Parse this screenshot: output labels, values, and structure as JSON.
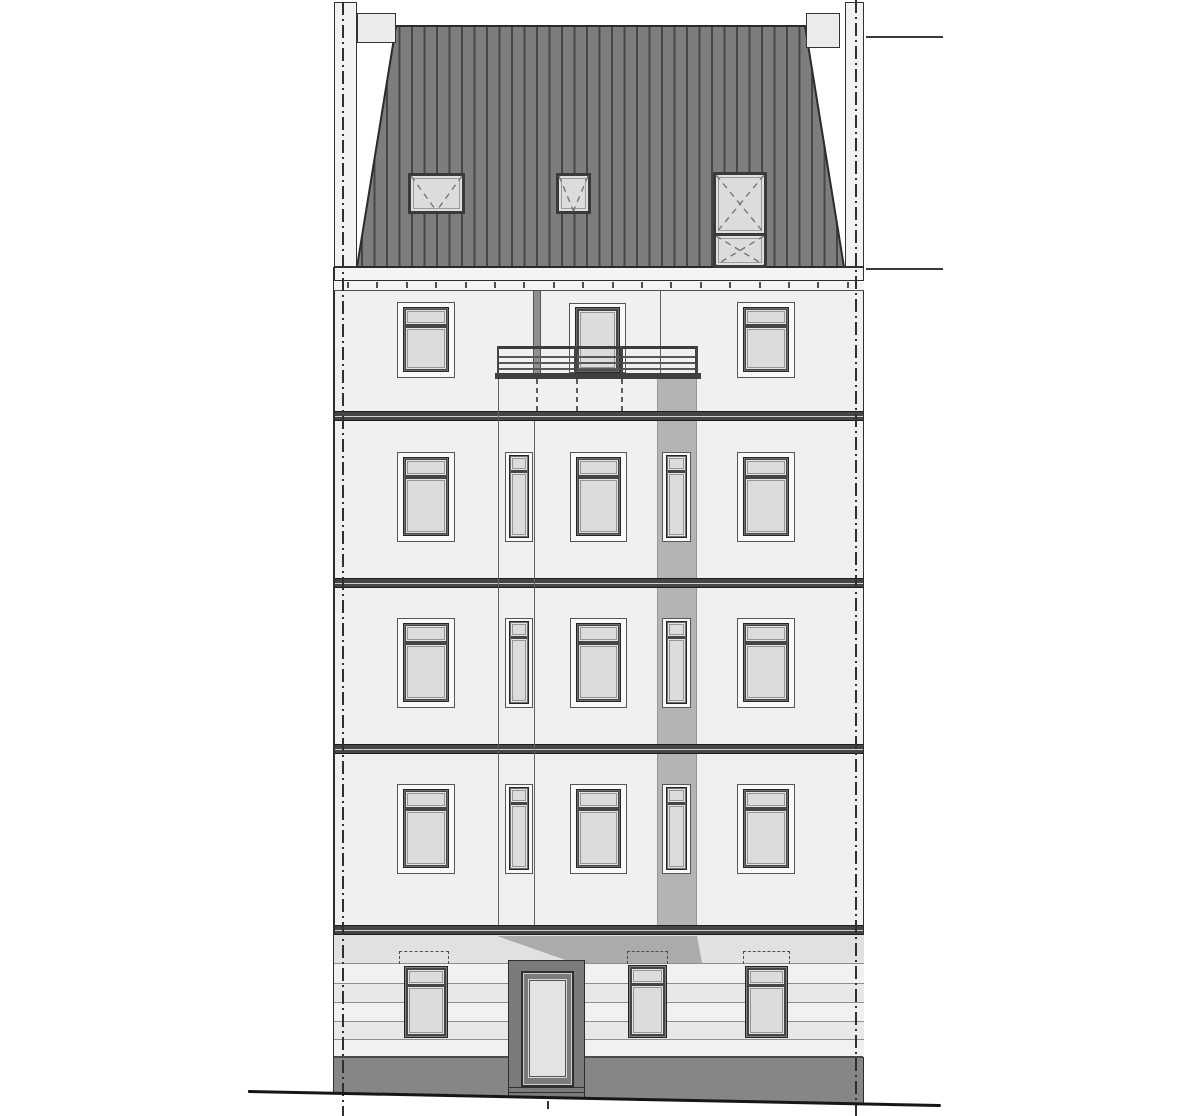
{
  "meta": {
    "description": "Front elevation architectural drawing of a 5-storey residential building: standing-seam mansard roof with two chimneys and three roof hatches, four upper floors with tilt-transom windows and narrow stair windows, a top-floor balcony with railing, a grey refuse/chute band descending the facade, a rusticated ground floor with central entrance door, dark plinth and sloping ground line, dash-dot plot boundary lines on both sides and two horizontal reference lines at the right edge."
  },
  "colors": {
    "page": "#ffffff",
    "wall": "#f0f0f0",
    "wall_edge": "#2e2e2e",
    "surround": "#f9f9f9",
    "surround_line": "#565656",
    "frame": "#454545",
    "frame_dark": "#242424",
    "frame_bevel": "#6e6e6e",
    "glass": "#dcdcdc",
    "glass_line": "#949494",
    "band": "#454545",
    "band_line": "#1e1e1e",
    "band_mid": "#cfcfcf",
    "roof": "#7d7d7d",
    "roof_seam": "#464646",
    "roof_edge": "#2b2b2b",
    "roof_window_frame": "#3a3a3a",
    "chute": "#b4b4b4",
    "diag": "#ababab",
    "downspout": "#8f8f8f",
    "plinth": "#868686",
    "plinth_edge": "#4a4a4a",
    "door_surround": "#7b7b7b",
    "door_leaf": "#e3e3e3",
    "ground_dark": "#e1e1e1",
    "ground_mid": "#e8e8e8",
    "ground_light": "#f1f1f1",
    "rustication_line": "#8e8e8e",
    "joint": "#606060",
    "rail": "#3c3c3c",
    "rail_thin": "#585858",
    "eaves_bg": "#f4f4f4",
    "tick": "#4f4f4f",
    "boundary": "#2f2f2f",
    "ref_line": "#3a3a3a",
    "ground_line": "#161616",
    "dash": "#5a5a5a",
    "lintel_dash": "#4f4f4f"
  },
  "blueprint": {
    "canvas": {
      "w": 1200,
      "h": 1116
    },
    "site": {
      "ground_line": {
        "x1": 248,
        "y1": 1090,
        "x2": 941,
        "y2": 1104,
        "thickness": 2.6
      },
      "boundary_lines": [
        {
          "x": 342,
          "y": 2,
          "h": 1114
        },
        {
          "x": 855,
          "y": 0,
          "h": 1116
        }
      ],
      "reference_lines": [
        {
          "x": 866,
          "y": 36,
          "w": 77
        },
        {
          "x": 866,
          "y": 268,
          "w": 77
        }
      ]
    },
    "roof": {
      "outline": [
        [
          357,
          267
        ],
        [
          396,
          26
        ],
        [
          805,
          26
        ],
        [
          844,
          267
        ]
      ],
      "seam_start": 362,
      "seam_step": 12.5,
      "seam_end": 841,
      "windows": [
        {
          "x": 408,
          "y": 173,
          "w": 57,
          "h": 41,
          "glyph": "V"
        },
        {
          "x": 556,
          "y": 173,
          "w": 35,
          "h": 41,
          "glyph": "V"
        },
        {
          "x": 713,
          "y": 172,
          "w": 54,
          "h": 64,
          "glyph": "X"
        },
        {
          "x": 713,
          "y": 233,
          "w": 54,
          "h": 35,
          "glyph": "X"
        }
      ],
      "chimneys": [
        {
          "x": 357,
          "y": 13,
          "w": 39,
          "h": 30
        },
        {
          "x": 806,
          "y": 13,
          "w": 34,
          "h": 35
        }
      ],
      "party_walls": [
        {
          "x": 334,
          "y": 2,
          "w": 23,
          "h": 265
        },
        {
          "x": 845,
          "y": 2,
          "w": 19,
          "h": 265
        }
      ]
    },
    "eaves": {
      "fascia": {
        "x": 334,
        "y": 267,
        "w": 530,
        "h": 14
      },
      "tick_band": {
        "x": 334,
        "y": 281,
        "w": 530,
        "h": 10
      },
      "tick_start": 347,
      "tick_step": 29.4,
      "tick_count": 18
    },
    "facade": {
      "wall": {
        "x": 334,
        "y": 291,
        "w": 530,
        "h": 645
      },
      "edge_left": {
        "x": 333.4,
        "y": 267,
        "w": 1.6,
        "h": 826
      },
      "edge_right": {
        "x": 862.6,
        "y": 267,
        "w": 1.6,
        "h": 837
      },
      "floor_bands": [
        {
          "y": 411
        },
        {
          "y": 578
        },
        {
          "y": 744
        },
        {
          "y": 925
        }
      ],
      "band_h": 10,
      "joint_lines": [
        {
          "x": 498,
          "y": 347,
          "h": 578
        },
        {
          "x": 534,
          "y": 421,
          "h": 504
        },
        {
          "x": 660,
          "y": 291,
          "h": 82
        }
      ],
      "chute": {
        "x": 657,
        "y": 378,
        "w": 40,
        "h": 558
      },
      "downspout": {
        "x": 533,
        "y": 290,
        "w": 8,
        "h": 84
      },
      "columns": {
        "c1": {
          "x": 397,
          "w": 58,
          "type": "big"
        },
        "c2": {
          "x": 505,
          "w": 28,
          "type": "narrow"
        },
        "c3": {
          "x": 570,
          "w": 57,
          "type": "big"
        },
        "c4": {
          "x": 662,
          "w": 29,
          "type": "narrow"
        },
        "c5": {
          "x": 737,
          "w": 58,
          "type": "big"
        }
      },
      "window_rows": [
        {
          "floor": "4og",
          "y": 302,
          "h": 76,
          "cols": [
            "c1",
            "c5"
          ]
        },
        {
          "floor": "3og",
          "y": 452,
          "h": 90,
          "cols": [
            "c1",
            "c2",
            "c3",
            "c4",
            "c5"
          ]
        },
        {
          "floor": "2og",
          "y": 618,
          "h": 90,
          "cols": [
            "c1",
            "c2",
            "c3",
            "c4",
            "c5"
          ]
        },
        {
          "floor": "1og",
          "y": 784,
          "h": 90,
          "cols": [
            "c1",
            "c2",
            "c3",
            "c4",
            "c5"
          ]
        }
      ]
    },
    "balcony": {
      "door": {
        "x": 569,
        "y": 303,
        "w": 57,
        "h": 70
      },
      "slab": {
        "x": 495,
        "y": 373,
        "w": 206,
        "h": 6
      },
      "top_rail": {
        "x": 497,
        "y": 346,
        "w": 201,
        "h": 3
      },
      "thin_rails_y": [
        356,
        362,
        368
      ],
      "rail_x": 497,
      "rail_w": 201,
      "posts": [
        {
          "x": 497,
          "w": 2
        },
        {
          "x": 574,
          "w": 3
        },
        {
          "x": 620,
          "w": 3
        },
        {
          "x": 695,
          "w": 3
        }
      ],
      "post_y": 346,
      "post_h": 28,
      "drops": [
        536,
        576,
        621
      ],
      "drop_y": 379,
      "drop_h": 33
    },
    "ground_floor": {
      "rows": [
        {
          "y": 935,
          "h": 28,
          "shade": "dark"
        },
        {
          "y": 963,
          "h": 20,
          "shade": "light"
        },
        {
          "y": 983,
          "h": 19,
          "shade": "mid"
        },
        {
          "y": 1002,
          "h": 19,
          "shade": "light"
        },
        {
          "y": 1021,
          "h": 18,
          "shade": "mid"
        },
        {
          "y": 1039,
          "h": 18,
          "shade": "light"
        }
      ],
      "row_lines": [
        963,
        983,
        1002,
        1021,
        1039
      ],
      "diag_band": {
        "x": 497,
        "y": 936,
        "w": 205,
        "h": 27,
        "points": "0,0 200,0 205,27 77,27"
      },
      "windows": [
        {
          "x": 404,
          "y": 966,
          "w": 44,
          "h": 72
        },
        {
          "x": 628,
          "y": 965,
          "w": 39,
          "h": 73
        },
        {
          "x": 745,
          "y": 966,
          "w": 43,
          "h": 72
        }
      ],
      "lintels": [
        {
          "x": 399,
          "y": 951,
          "w": 50,
          "h": 13
        },
        {
          "x": 627,
          "y": 951,
          "w": 41,
          "h": 13
        },
        {
          "x": 743,
          "y": 951,
          "w": 47,
          "h": 13
        }
      ],
      "door": {
        "surround": {
          "x": 508,
          "y": 960,
          "w": 77,
          "h": 138
        },
        "frame": {
          "x": 521,
          "y": 971,
          "w": 53,
          "h": 116
        },
        "step_lines_y": [
          1087,
          1092
        ],
        "center_tick": {
          "x": 547,
          "y": 1101,
          "w": 2,
          "h": 8
        }
      },
      "plinth": {
        "x": 334,
        "y": 1057,
        "w": 529,
        "h": 47,
        "points": "0,0 529,0 529,46 0,35"
      }
    }
  }
}
